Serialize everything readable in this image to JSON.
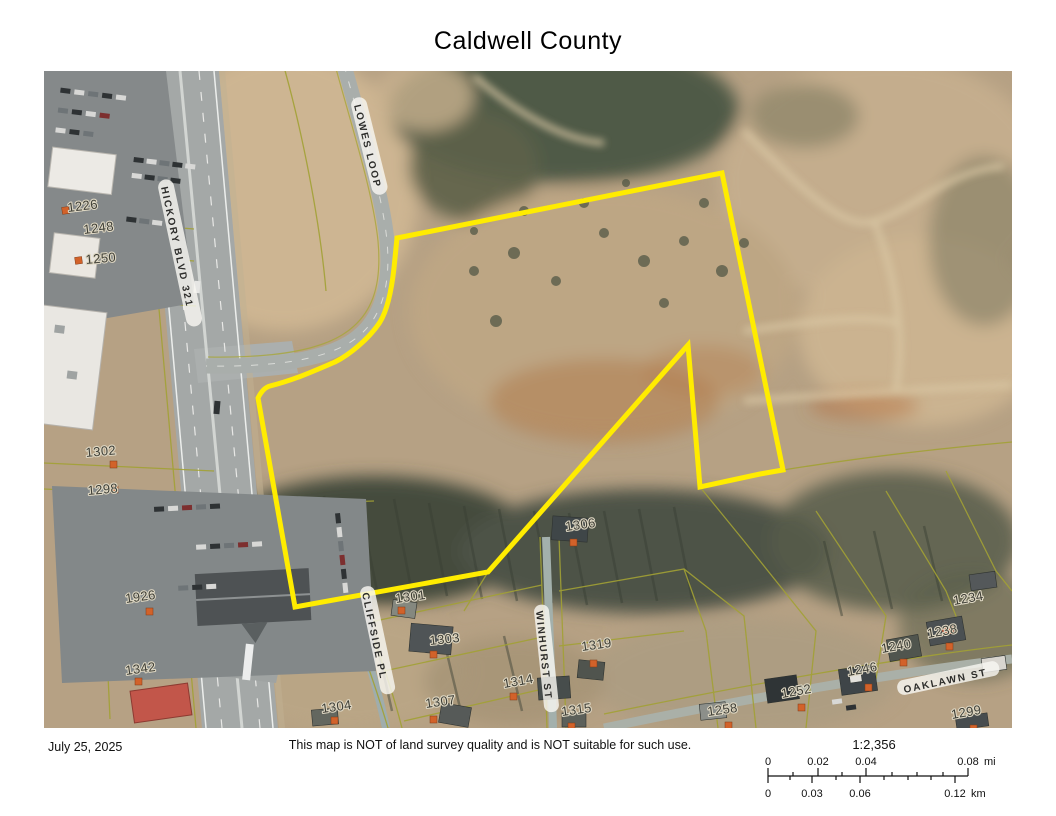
{
  "title": "Caldwell County",
  "footer": {
    "date": "July 25, 2025",
    "disclaimer": "This map is NOT of land survey quality and is NOT suitable for such use.",
    "scale": {
      "ratio": "1:2,356",
      "mi_labels": [
        "0",
        "0.02",
        "0.04",
        "0.08"
      ],
      "mi_unit": "mi",
      "km_labels": [
        "0",
        "0.03",
        "0.06",
        "0.12"
      ],
      "km_unit": "km"
    }
  },
  "map": {
    "roads": [
      {
        "name": "HICKORY BLVD 321"
      },
      {
        "name": "LOWES LOOP"
      },
      {
        "name": "CLIFFSIDE PL"
      },
      {
        "name": "WINHURST ST"
      },
      {
        "name": "OAKLAWN ST"
      }
    ],
    "parcel_numbers": [
      "1226",
      "1248",
      "1250",
      "1302",
      "1298",
      "1926",
      "1342",
      "1301",
      "1303",
      "1304",
      "1307",
      "1306",
      "1314",
      "1319",
      "1315",
      "1234",
      "1238",
      "1240",
      "1246",
      "1252",
      "1258",
      "1299"
    ],
    "colors": {
      "parcel_boundary": "#ffec00",
      "parcel_lines": "#a2a135",
      "address_marker": "#d2622a",
      "road_fill": "#a4a8a7"
    }
  }
}
